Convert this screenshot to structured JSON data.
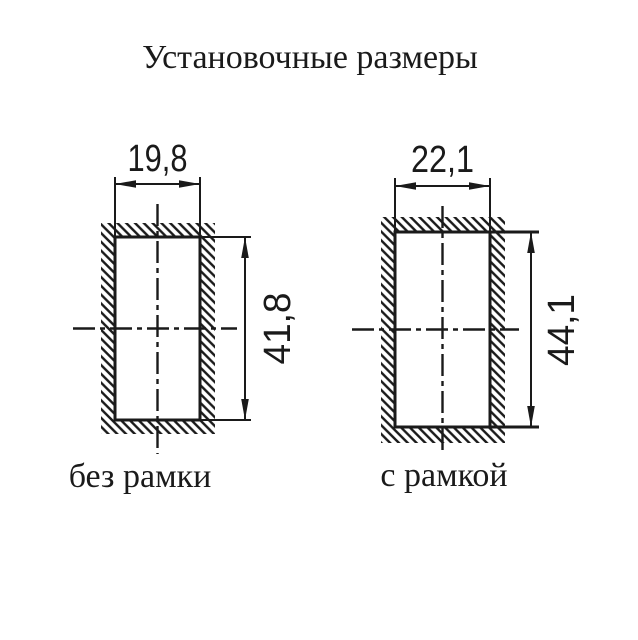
{
  "title": "Установочные размеры",
  "colors": {
    "ink": "#1a1a1a",
    "background": "#ffffff"
  },
  "diagrams": [
    {
      "id": "without-frame",
      "caption": "без рамки",
      "cutout_width": "19,8",
      "cutout_height": "41,8"
    },
    {
      "id": "with-frame",
      "caption": "с рамкой",
      "cutout_width": "22,1",
      "cutout_height": "44,1"
    }
  ]
}
